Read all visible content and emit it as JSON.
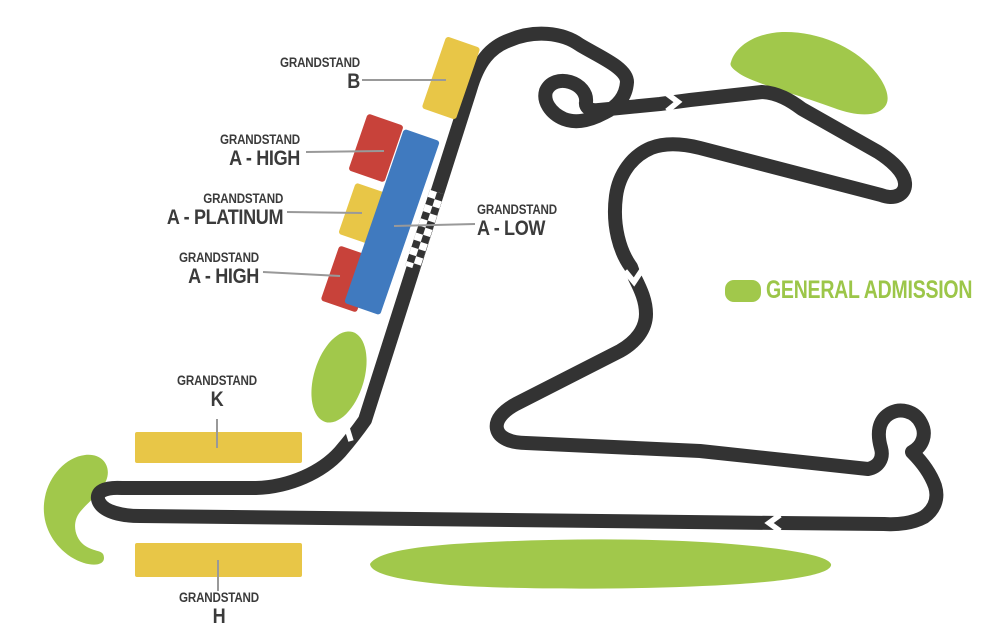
{
  "labels": {
    "grandstand": "GRANDSTAND",
    "b": "B",
    "a_high_upper": "A - HIGH",
    "a_platinum": "A - PLATINUM",
    "a_high_lower": "A - HIGH",
    "a_low": "A - LOW",
    "k": "K",
    "h": "H"
  },
  "legend": {
    "label": "GENERAL ADMISSION"
  },
  "stands": [
    {
      "name": "Grandstand B",
      "tier_color": "yellow"
    },
    {
      "name": "Grandstand A - High (upper)",
      "tier_color": "red"
    },
    {
      "name": "Grandstand A - Platinum",
      "tier_color": "yellow"
    },
    {
      "name": "Grandstand A - High (lower)",
      "tier_color": "red"
    },
    {
      "name": "Grandstand A - Low",
      "tier_color": "blue"
    },
    {
      "name": "Grandstand K",
      "tier_color": "yellow"
    },
    {
      "name": "Grandstand H",
      "tier_color": "yellow"
    }
  ],
  "colors": {
    "track": "#333333",
    "yellow_stand": "#E8C647",
    "red_stand": "#C8423A",
    "blue_stand": "#407ABF",
    "general_admission": "#A1C84B",
    "stand_outline": "#3A3A3A",
    "connector_line": "#999999",
    "direction_arrow": "#FFFFFF",
    "checker_dark": "#333333",
    "label_text": "#3B3B3B"
  }
}
